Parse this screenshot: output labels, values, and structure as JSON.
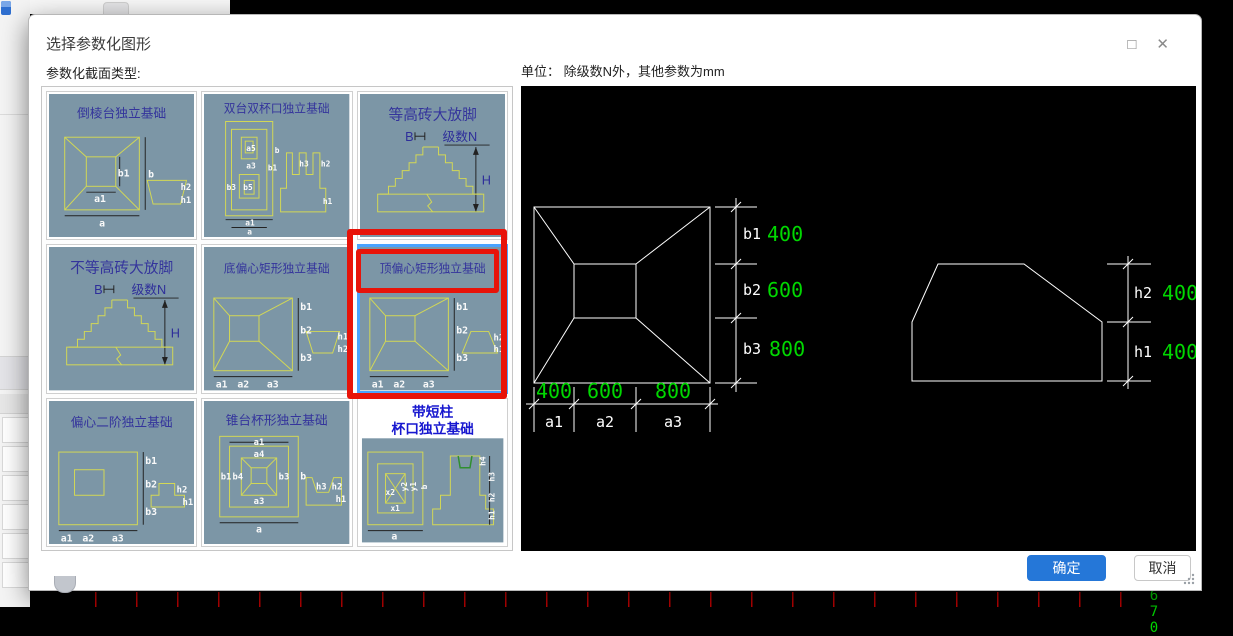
{
  "dialog": {
    "title": "选择参数化图形",
    "section_label": "参数化截面类型:",
    "ok": "确定",
    "cancel": "取消",
    "maximize_icon": "□",
    "close_icon": "✕"
  },
  "preview": {
    "unit_label": "单位：  除级数N外，其他参数为mm",
    "plan": {
      "row_labels": [
        "b1",
        "b2",
        "b3"
      ],
      "row_values": [
        "400",
        "600",
        "800"
      ],
      "col_labels": [
        "a1",
        "a2",
        "a3"
      ],
      "col_values": [
        "400",
        "600",
        "800"
      ]
    },
    "elevation": {
      "row_labels": [
        "h2",
        "h1"
      ],
      "row_values": [
        "400",
        "400"
      ]
    }
  },
  "thumbs": [
    {
      "title": "倒棱台独立基础",
      "labels": [
        "b1",
        "b",
        "a1",
        "a",
        "h2",
        "h1"
      ]
    },
    {
      "title": "双台双杯口独立基础",
      "labels": [
        "a5",
        "a3",
        "b1",
        "b",
        "b3",
        "b5",
        "a1",
        "a",
        "h3",
        "h2",
        "h1"
      ]
    },
    {
      "title": "等高砖大放脚",
      "labels": [
        "B",
        "级数N",
        "H"
      ]
    },
    {
      "title": "不等高砖大放脚",
      "labels": [
        "B",
        "级数N",
        "H"
      ]
    },
    {
      "title": "底偏心矩形独立基础",
      "labels": [
        "b1",
        "b2",
        "b3",
        "a1",
        "a2",
        "a3",
        "h1",
        "h2"
      ]
    },
    {
      "title": "顶偏心矩形独立基础",
      "labels": [
        "b1",
        "b2",
        "b3",
        "a1",
        "a2",
        "a3",
        "h2",
        "h1"
      ],
      "selected": true
    },
    {
      "title": "偏心二阶独立基础",
      "labels": [
        "b1",
        "b2",
        "b3",
        "a1",
        "a2",
        "a3",
        "h2",
        "h1"
      ]
    },
    {
      "title": "锥台杯形独立基础",
      "labels": [
        "a1",
        "a4",
        "b1",
        "b4",
        "b3",
        "b",
        "a3",
        "a",
        "h3",
        "h2",
        "h1"
      ]
    },
    {
      "title_line1": "带短柱",
      "title_line2": "杯口独立基础",
      "labels": [
        "x2",
        "y2",
        "x1",
        "y1",
        "b",
        "a",
        "h4",
        "h3",
        "h2",
        "h1"
      ]
    }
  ],
  "background": {
    "axis_label": "670"
  },
  "colors": {
    "accent_blue": "#2577d8",
    "annotation_red": "#e81309",
    "selection_blue": "#49a3fe",
    "thumb_bg": "#7c96a6",
    "drawing_yellow": "#d3d855",
    "cad_green": "#00d800"
  }
}
